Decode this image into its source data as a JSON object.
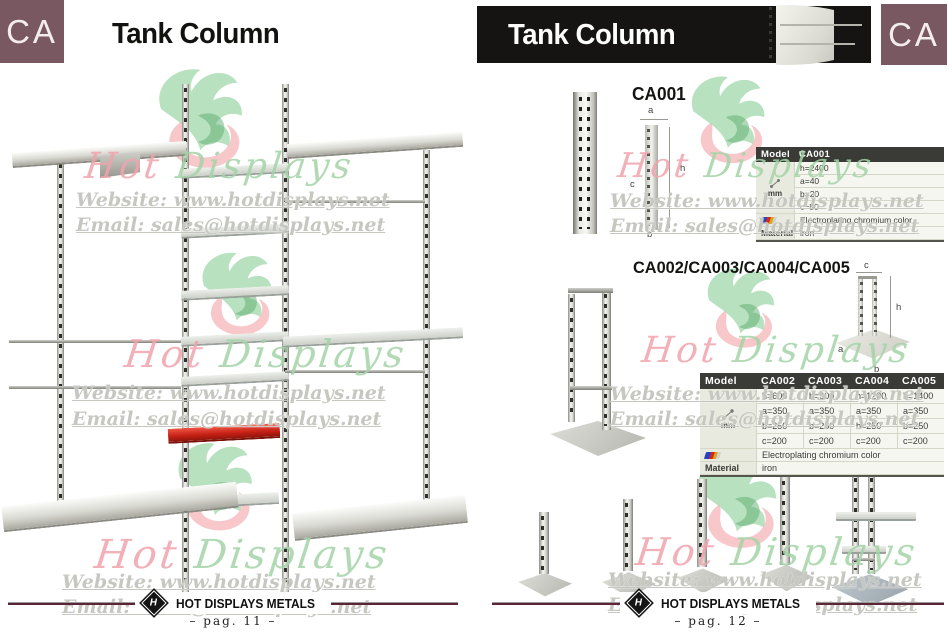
{
  "watermark": {
    "script_hot": "Hot",
    "script_displays": "Displays",
    "website": "Website: www.hotdisplays.net",
    "email": "Email: sales@hotdisplays.net"
  },
  "left_page": {
    "section_code": "CA",
    "title": "Tank Column",
    "footer": {
      "brand": "HOT DISPLAYS METALS",
      "page": "– pag. 11 –"
    }
  },
  "right_page": {
    "section_code": "CA",
    "title": "Tank Column",
    "footer": {
      "brand": "HOT DISPLAYS METALS",
      "page": "– pag. 12 –"
    },
    "ca001": {
      "heading": "CA001",
      "diagram": {
        "a": "a",
        "h": "h",
        "c": "c",
        "b": "b"
      },
      "table": {
        "model_label": "Model",
        "model": "CA001",
        "unit": "mm",
        "h": "h=2400",
        "a": "a=40",
        "b": "b=20",
        "c": "c=50",
        "finish": "Electroplating chromium color",
        "material_label": "Material",
        "material": "iron"
      }
    },
    "ca_series": {
      "heading": "CA002/CA003/CA004/CA005",
      "diagram": {
        "c": "c",
        "h": "h",
        "a": "a",
        "b": "b"
      },
      "table": {
        "model_label": "Model",
        "models": [
          "CA002",
          "CA003",
          "CA004",
          "CA005"
        ],
        "unit": "mm",
        "rows": {
          "h": [
            "h=600",
            "h=900",
            "h=1200",
            "h=1400"
          ],
          "a": [
            "a=350",
            "a=350",
            "a=350",
            "a=350"
          ],
          "b": [
            "b=250",
            "b=250",
            "b=250",
            "b=250"
          ],
          "c": [
            "c=200",
            "c=200",
            "c=200",
            "c=200"
          ]
        },
        "finish": "Electroplating chromium color",
        "material_label": "Material",
        "material": "iron"
      }
    }
  }
}
